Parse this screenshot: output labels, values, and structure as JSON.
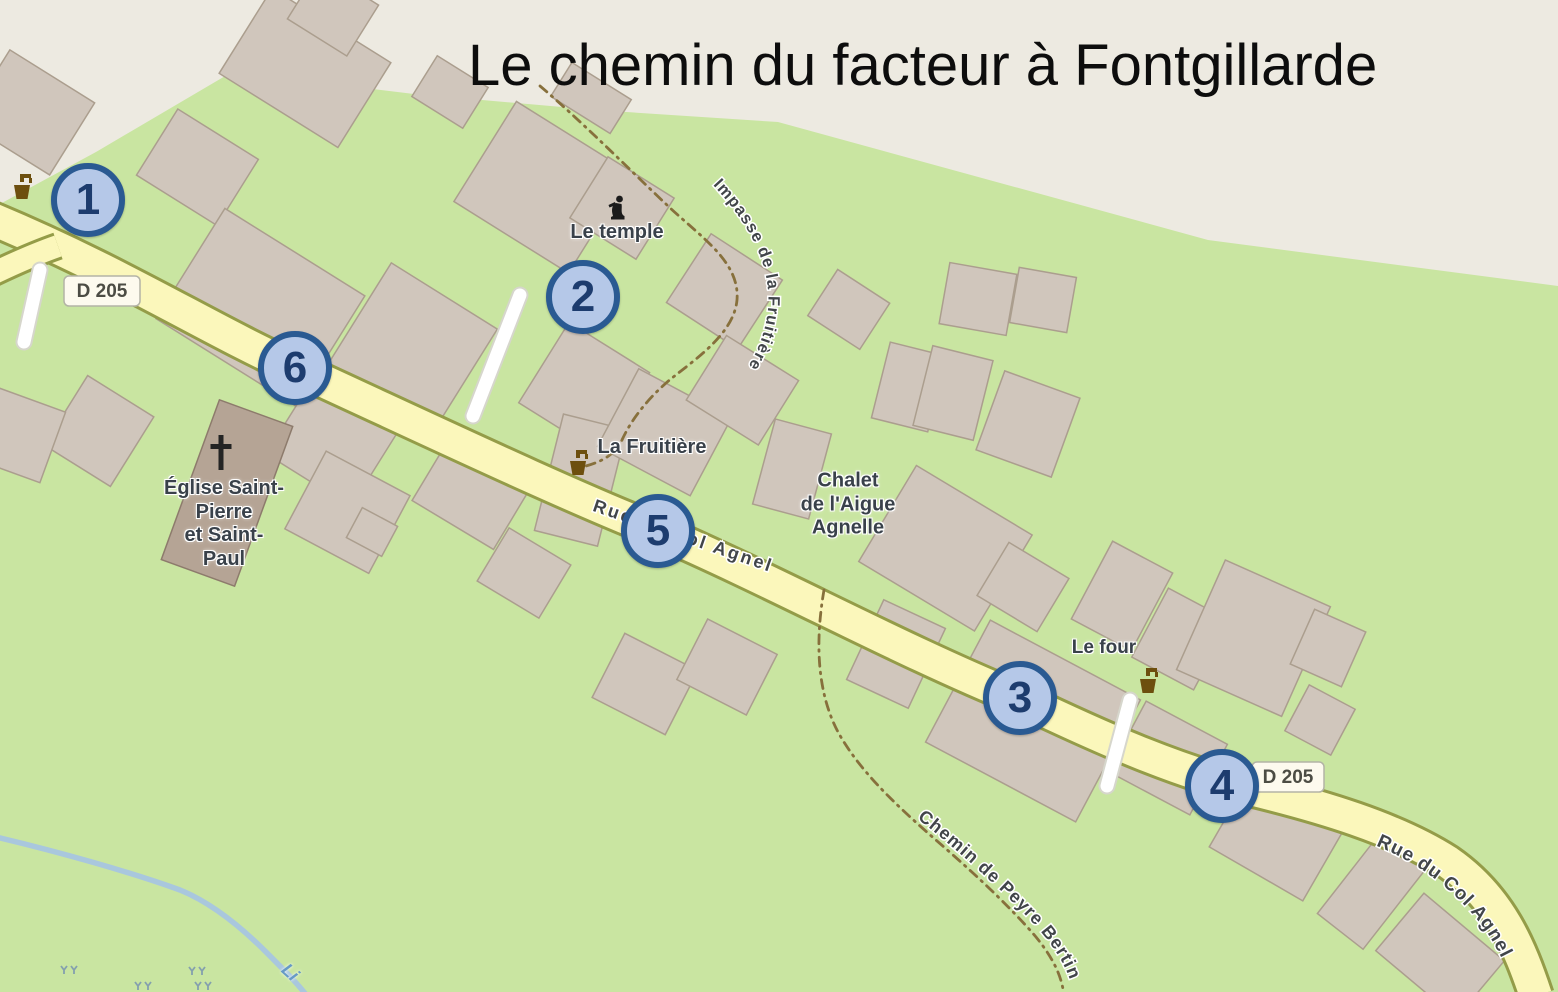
{
  "title": "Le chemin du facteur à Fontgillarde",
  "map": {
    "road_ref": "D 205",
    "street_names": {
      "rue_du_col_agnel": "Rue du Col Agnel",
      "impasse_de_la_fruitiere": "Impasse de la Fruitière",
      "chemin_de_peyre_bertino": "Chemin de Peyre Bertino"
    },
    "place_labels": {
      "temple": "Le temple",
      "fruitiere": "La Fruitière",
      "church": "Église Saint-\nPierre\net Saint-\nPaul",
      "chalet": "Chalet\nde l'Aigue\nAgnelle",
      "four": "Le four",
      "stream_label_fragment": "Li"
    },
    "markers": [
      {
        "label": "1"
      },
      {
        "label": "2"
      },
      {
        "label": "3"
      },
      {
        "label": "4"
      },
      {
        "label": "5"
      },
      {
        "label": "6"
      }
    ],
    "colors": {
      "marker_fill": "#b5c8e8",
      "marker_border": "#2a5a92",
      "marker_text": "#1d3c6e",
      "road_fill": "#fbf7bb",
      "road_casing": "#949c48",
      "grass": "#c9e5a1",
      "unmapped_area": "#edeae1",
      "building_fill": "#d0c6bc",
      "building_outline": "#ab9e8e",
      "church_fill": "#b5a495",
      "footpath_dash": "#87703c",
      "stream": "#a9c7dd",
      "label_text": "#39414a",
      "title_text": "#0d0d0d"
    }
  }
}
